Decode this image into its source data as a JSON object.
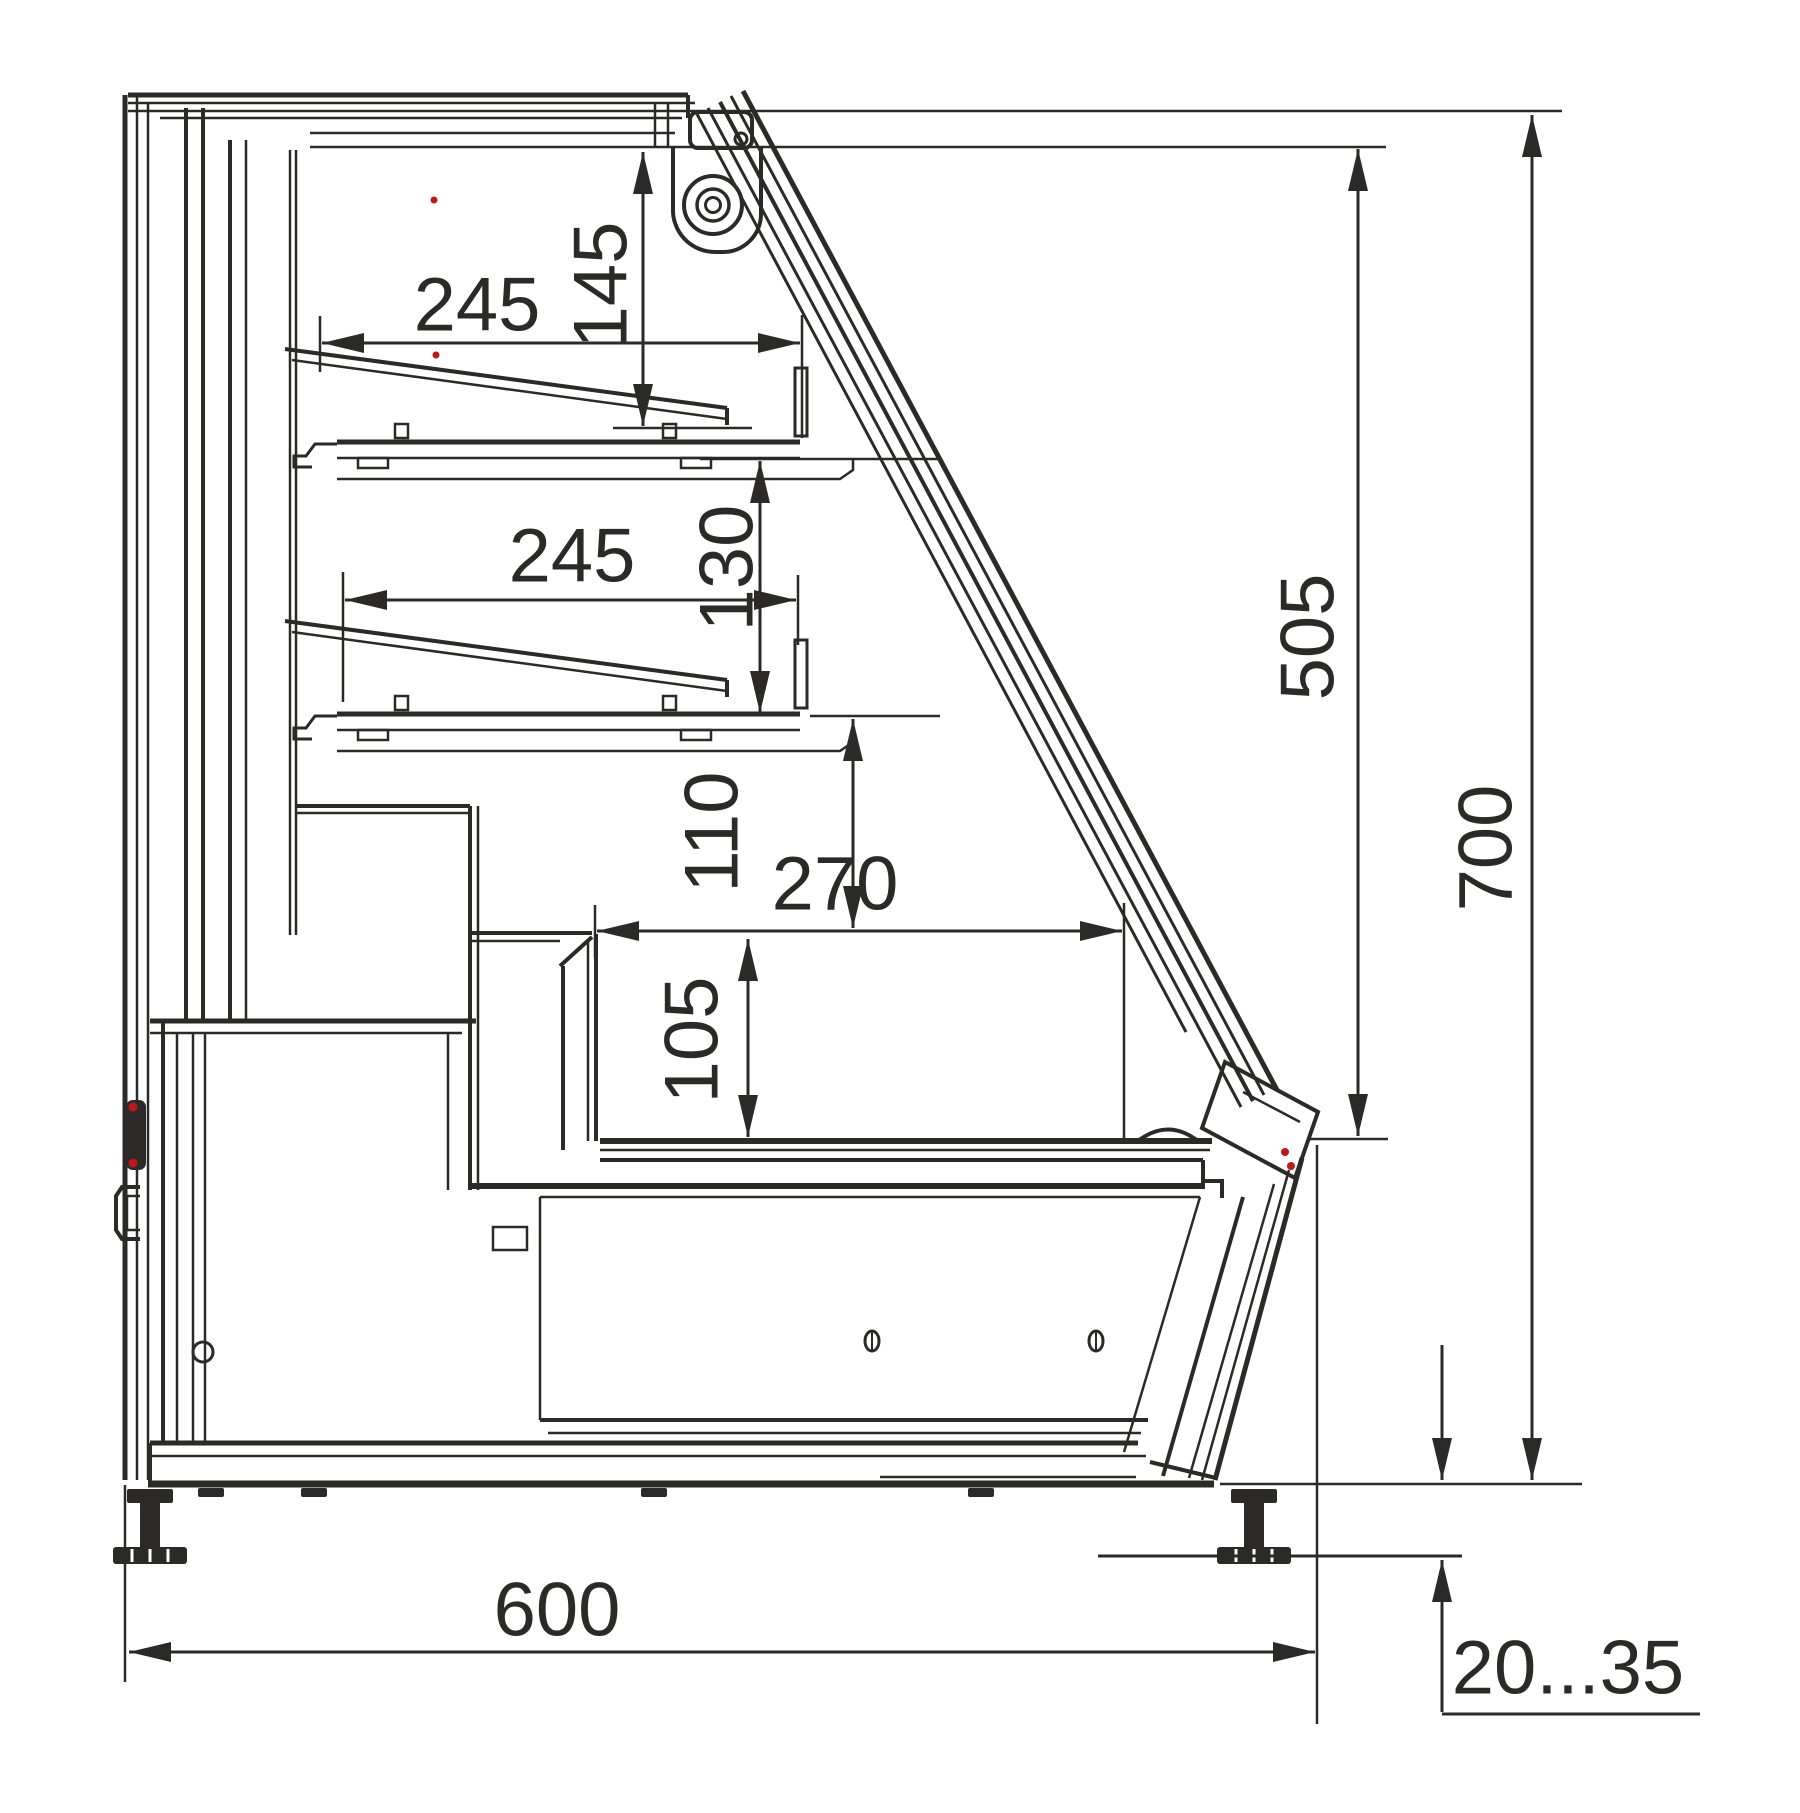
{
  "drawing": {
    "type": "technical-section-drawing",
    "subject": "refrigerated-display-case-side-cross-section",
    "units": "mm",
    "colors": {
      "line": "#2b2a29",
      "accent": "#c01818",
      "background": "#ffffff"
    },
    "dimensions": {
      "shelf1_depth": "245",
      "canopy_to_shelf1": "145",
      "shelf2_depth": "245",
      "shelf1_to_shelf2": "130",
      "shelf2_to_well_top": "110",
      "well_opening_width": "270",
      "well_depth": "105",
      "glass_opening_height": "505",
      "body_height": "700",
      "base_depth": "600",
      "leveling_feet_range": "20...35"
    }
  }
}
